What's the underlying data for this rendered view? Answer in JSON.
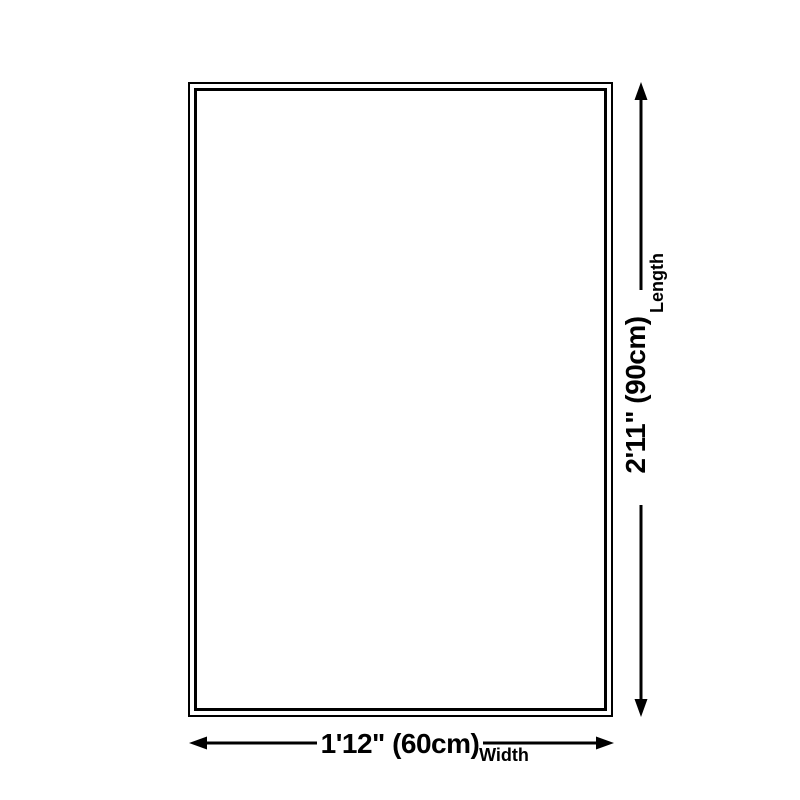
{
  "diagram": {
    "type": "product-size-diagram",
    "background_color": "#ffffff",
    "line_color": "#000000",
    "length_dimension": {
      "value": "2'11\" (90cm)",
      "label": "Length"
    },
    "width_dimension": {
      "value": "1'12\" (60cm)",
      "label": "Width"
    }
  }
}
